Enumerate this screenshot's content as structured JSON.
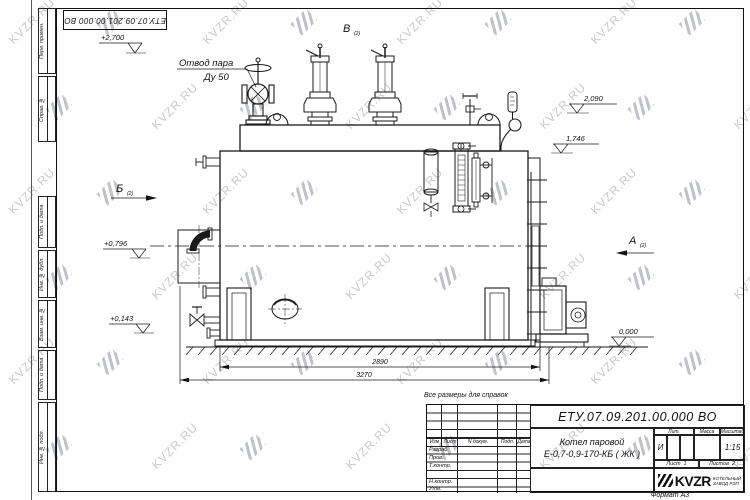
{
  "watermark": {
    "text": "KVZR.RU"
  },
  "stamp_top": {
    "doc_number": "ЕТУ.07.09.201.00.000 ВО"
  },
  "margin_fields": {
    "f1": "Перв. примен.",
    "f2": "Справ. №",
    "f3": "Подп. и дата",
    "f4": "Инв. № дубл.",
    "f5": "Взам. инв. №",
    "f6": "Подп. и дата",
    "f7": "Инв. № подл."
  },
  "drawing": {
    "steam_outlet_label": {
      "line1": "Отвод пара",
      "line2": "Ду 50"
    },
    "views": {
      "a": "А",
      "b": "Б",
      "v": "В",
      "sheet_ref": "(2)"
    },
    "elevations": {
      "top": "+2,700",
      "right_upper": "2,090",
      "right_lower": "1,746",
      "left_upper": "+0,796",
      "left_lower": "+0,143",
      "ground": "0,000"
    },
    "dimensions": {
      "inner": "2890",
      "overall": "3270"
    },
    "note": "Все размеры для справок"
  },
  "title_block": {
    "doc_number": "ЕТУ.07.09.201.00.000  ВО",
    "product_name_line1": "Котел паровой",
    "product_name_line2": "Е-0,7-0,9-170-КБ ( ЖК )",
    "rev_header": {
      "izm": "Изм",
      "list": "Лист",
      "n_dokum": "N докум.",
      "podp": "Подп.",
      "data": "Дата"
    },
    "sig_rows": [
      "Разраб.",
      "Пров.",
      "Т.контр.",
      "",
      "Н.контр.",
      "Утв."
    ],
    "lit_header": "Лит.",
    "massa_header": "Масса",
    "masshtab_header": "Масштаб",
    "lit_value": "И",
    "scale_value": "1:15",
    "sheet_label": "Лист",
    "sheet_value": "1",
    "sheets_label": "Листов",
    "sheets_value": "2",
    "company_logo_text": "KVZR",
    "company_name_line1": "КОТЕЛЬНЫЙ",
    "company_name_line2": "ЗАВОД РЭП",
    "format_label": "Формат А3"
  }
}
